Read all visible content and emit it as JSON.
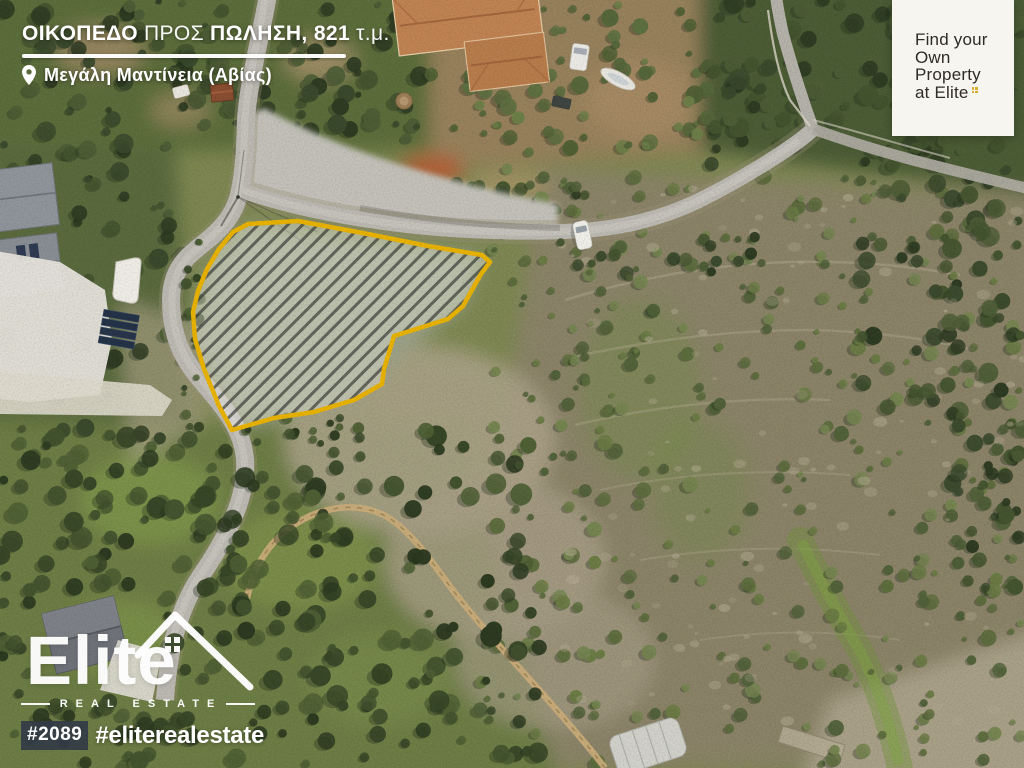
{
  "header": {
    "title_bold_1": "ΟΙΚΟΠΕΔΟ",
    "title_light_1": "ΠΡΟΣ",
    "title_bold_2": "ΠΩΛΗΣΗ, 821",
    "title_light_2": "τ.μ.",
    "location": "Μεγάλη Μαντίνεια (Αβίας)"
  },
  "promo_card": {
    "line1": "Find your",
    "line2": "Own",
    "line3": "Property",
    "line4": "at Elite"
  },
  "watermark": {
    "brand": "Elite",
    "subtitle": "REAL ESTATE",
    "listing_number": "#2089",
    "hashtag": "#eliterealestate"
  },
  "plot": {
    "outline_points": "248,224 298,221 368,234 428,246 482,255 490,262 481,274 463,306 448,319 394,336 384,369 382,384 354,400 314,412 274,418 246,426 232,430 219,406 204,369 195,339 193,312 198,291 207,269 219,249 233,232",
    "outline_color": "#e9b303"
  },
  "colors": {
    "plot_outline_gold": "#e9b303",
    "logo_gold": "#d9ad2b",
    "badge_background": "#333b46",
    "card_background": "#f6f5f0",
    "text_white": "#ffffff"
  }
}
